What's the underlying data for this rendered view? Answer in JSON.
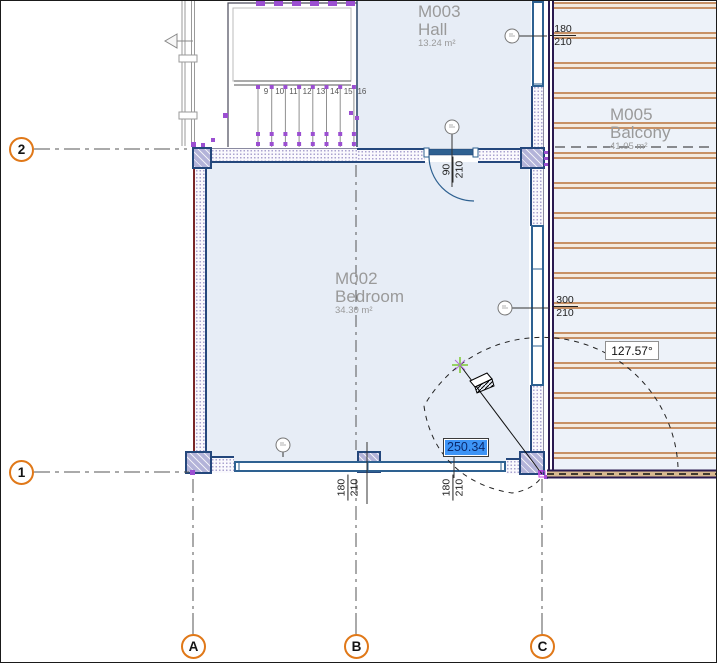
{
  "view": {
    "type": "floor-plan-canvas"
  },
  "rooms": [
    {
      "id": "M003",
      "name": "Hall",
      "area": "13.24 m²"
    },
    {
      "id": "M002",
      "name": "Bedroom",
      "area": "34.30 m²"
    },
    {
      "id": "M005",
      "name": "Balcony",
      "area": "41.05 m²"
    }
  ],
  "grid": {
    "horizontal": [
      "2",
      "1"
    ],
    "vertical": [
      "A",
      "B",
      "C"
    ]
  },
  "dimensions": {
    "door_top": {
      "width": "90",
      "height": "210"
    },
    "window_bottom_1": {
      "width": "180",
      "height": "210"
    },
    "window_bottom_2": {
      "width": "180",
      "height": "210"
    },
    "window_right": {
      "width": "300",
      "height": "210"
    },
    "window_top_right": {
      "width": "180",
      "height": "210"
    }
  },
  "tracker": {
    "distance": "250.34",
    "angle": "127.57°"
  },
  "stairs": {
    "tread_numbers": [
      "9",
      "10",
      "11",
      "12",
      "13",
      "14",
      "15",
      "16"
    ]
  },
  "colors": {
    "room_fill": "#e7edf6",
    "deck_board": "#c79166",
    "slab_edge": "#2a1a50",
    "wall_line": "#24477c",
    "window_frame": "#2e6191",
    "exterior_edge": "#7a2626",
    "selection_purple": "#9b4fd1",
    "grid_bubble_orange": "#e07818",
    "tracker_selection_blue": "#3d94f6",
    "room_text_gray": "#9a9a9a"
  }
}
